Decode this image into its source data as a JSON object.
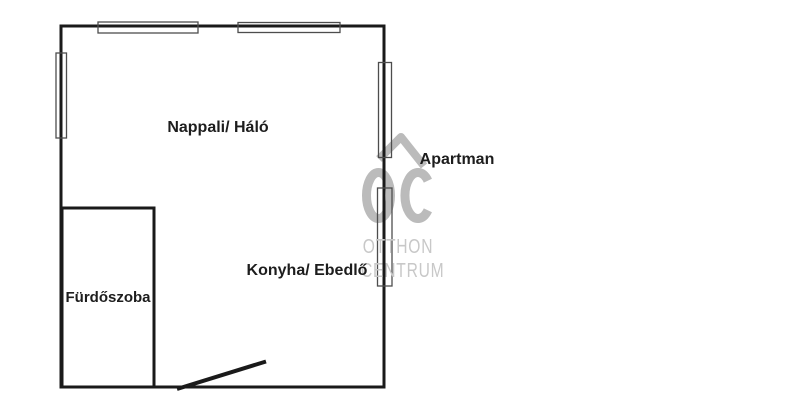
{
  "floorplan": {
    "title": "Apartman",
    "rooms": [
      {
        "id": "nappali-halo",
        "label": "Nappali/ Háló"
      },
      {
        "id": "konyha-ebedlo",
        "label": "Konyha/ Ebedlő"
      },
      {
        "id": "furdoszoba",
        "label": "Fürdőszoba"
      }
    ],
    "features": {
      "windows_count": 5,
      "doors_count": 1
    }
  },
  "watermark": {
    "monogram": "OC",
    "line1": "OTTHON",
    "line2": "CENTRUM",
    "monogram_color": "#bbbbbb",
    "text_color": "#c8c8c8"
  },
  "colors": {
    "background": "#ffffff",
    "wall": "#1a1a1a",
    "window_outline": "#4d4d4d",
    "label_text": "#1d1d1d"
  }
}
